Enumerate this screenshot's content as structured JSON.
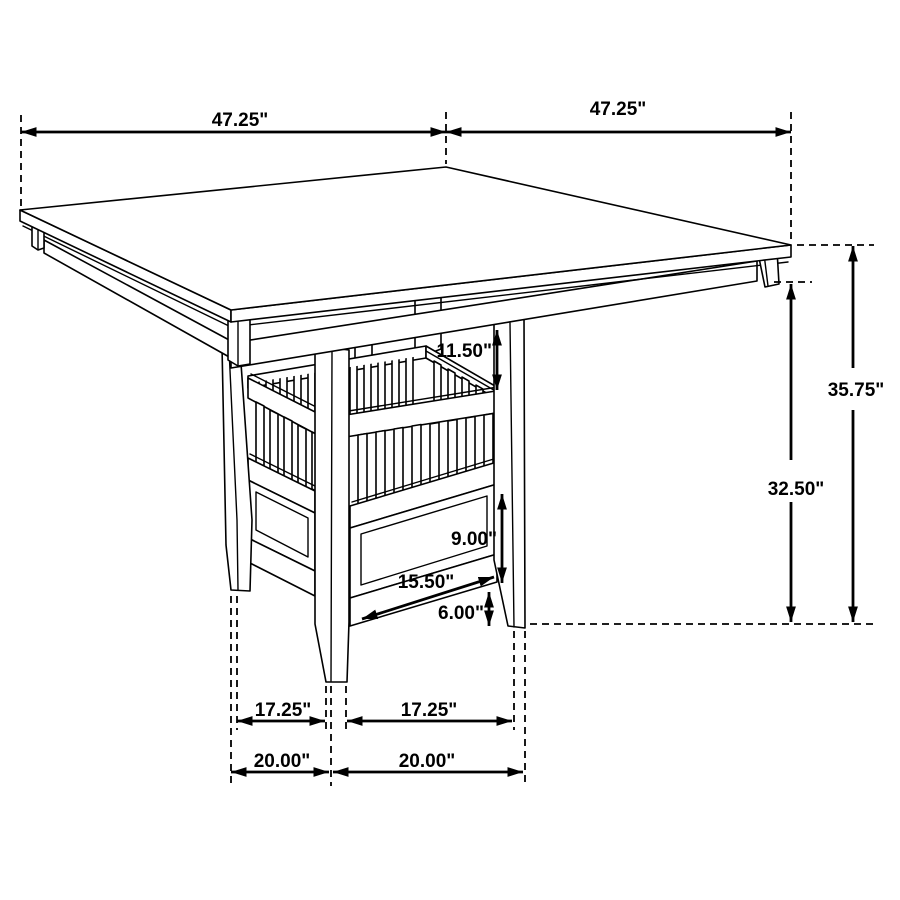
{
  "drawing": {
    "type": "furniture dimension diagram",
    "subject": "square counter-height pedestal dining table with slatted storage basket base"
  },
  "dimensions": {
    "top_width_left": "47.25\"",
    "top_width_right": "47.25\"",
    "overall_height": "35.75\"",
    "height_to_apron": "32.50\"",
    "apron_to_basket": "11.50\"",
    "storage_panel_height": "9.00\"",
    "storage_panel_width": "15.50\"",
    "base_clearance": "6.00\"",
    "foot_span_inner_left": "17.25\"",
    "foot_span_inner_right": "17.25\"",
    "foot_span_outer_left": "20.00\"",
    "foot_span_outer_right": "20.00\""
  },
  "colors": {
    "line": "#000000",
    "background": "#ffffff"
  }
}
